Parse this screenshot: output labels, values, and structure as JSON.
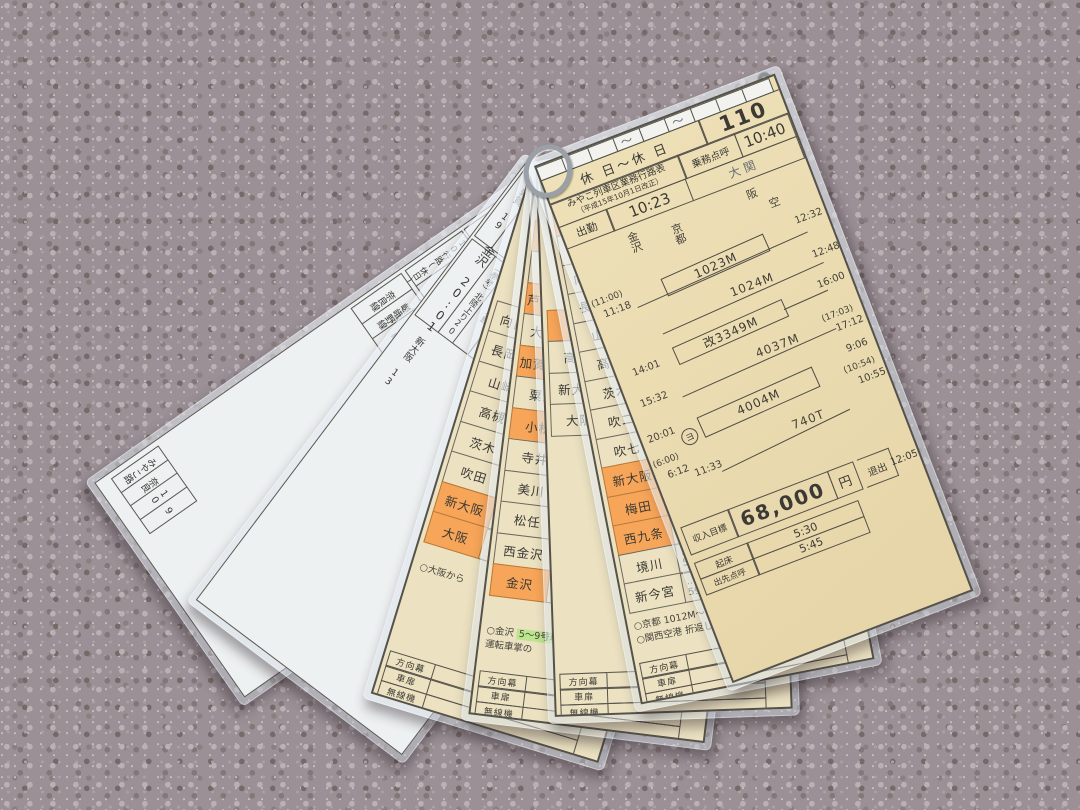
{
  "palette": {
    "carpet": "#9a9095",
    "paper_cream": "#ece2c2",
    "paper_tan": "#ead9b0",
    "paper_white": "#eef1f2",
    "highlight_orange": "#f7a558",
    "highlight_green": "#bde48e",
    "ink": "#3b3a35"
  },
  "card_top": {
    "header_day": "休 日～休 日",
    "route_no": "110",
    "title": "みやこ列車区業務行路表",
    "revision": "（平成15年10月1日改正）",
    "labels": {
      "shukkin": "出勤",
      "tenko": "乗務点呼",
      "taishutsu": "退出",
      "kisho": "起床",
      "shussaki": "出先点呼"
    },
    "times": {
      "shukkin": "10:23",
      "tenko": "10:40",
      "taishutsu": "12:05",
      "kisho": "5:30",
      "shussaki": "5:45"
    },
    "name_stamp": "大関",
    "diagram": {
      "axis": {
        "a1": "金沢",
        "a2": "京都",
        "a3": "阪",
        "a4": "空"
      },
      "s1": {
        "train": "1023M",
        "left1": "(11:00)",
        "left2": "11:18",
        "right1": "12:32"
      },
      "s2": {
        "train": "1024M",
        "right1": "12:48"
      },
      "s3": {
        "train": "改3349M",
        "left1": "14:01",
        "right1": "16:00"
      },
      "s4": {
        "train": "4037M",
        "left1": "15:32",
        "right1": "(17:03)",
        "right2": "17:12"
      },
      "s5": {
        "train": "4004M",
        "mark": "ヨ",
        "left1": "20:01",
        "left2": "(6:00)",
        "left3": "6:12",
        "right1": "9:06",
        "right2": "(10:54)",
        "right3": "10:55"
      },
      "s6": {
        "train": "740T",
        "left1": "11:33"
      }
    },
    "income": {
      "label": "収入目標",
      "amount": "68,000",
      "unit": "円"
    }
  },
  "card_kyoto": {
    "rows": [
      {
        "name": "京都",
        "hl": true,
        "t1": "",
        "t2": ""
      },
      {
        "name": "梅小路",
        "t1": "",
        "t2": ""
      },
      {
        "name": "向日町",
        "t1": "",
        "t2": ""
      },
      {
        "name": "長岡京",
        "t1": "",
        "t2": ""
      },
      {
        "name": "山崎",
        "t1": "",
        "t2": ""
      },
      {
        "name": "高槻",
        "t1": "",
        "t2": ""
      },
      {
        "name": "茨木",
        "t1": "",
        "t2": ""
      },
      {
        "name": "吹二",
        "t1": "",
        "t2": ""
      },
      {
        "name": "吹七",
        "t1": "",
        "t2": "45"
      },
      {
        "name": "新大阪",
        "hl": true,
        "t1": "11 45",
        "t2": "11 46"
      },
      {
        "name": "梅田",
        "hl": true,
        "t1": "…",
        "t2": "49 25"
      },
      {
        "name": "西九条",
        "hl": true,
        "t1": "11 53 20",
        "t2": "11 53 50"
      },
      {
        "name": "境川",
        "t1": "…",
        "t2": "56 30"
      },
      {
        "name": "新今宮",
        "t1": "…",
        "t2": "59 40"
      }
    ],
    "note1": "○京都 1012M～ 英放送あり",
    "note2": "○関西空港 折返し1024M"
  },
  "card_mid": {
    "rows": [
      {
        "name": "",
        "hl": true,
        "t1": "",
        "t2": ""
      },
      {
        "name": "高槻",
        "t1": "",
        "t2": ""
      },
      {
        "name": "新大阪",
        "t1": "",
        "t2": ""
      },
      {
        "name": "大阪",
        "t1": "",
        "t2": ""
      }
    ]
  },
  "card_hokuriku": {
    "rows": [
      {
        "name": "福井",
        "hl": true,
        "t1": "",
        "t2": ""
      },
      {
        "name": "丸岡",
        "t1": "",
        "t2": ""
      },
      {
        "name": "芦原温泉",
        "hl": true,
        "t1": "",
        "t2": ""
      },
      {
        "name": "大聖寺",
        "t1": "",
        "t2": ""
      },
      {
        "name": "加賀温泉",
        "hl": true,
        "t1": "",
        "t2": ""
      },
      {
        "name": "粟津",
        "t1": "",
        "t2": ""
      },
      {
        "name": "小松",
        "hl": true,
        "t1": "",
        "t2": ""
      },
      {
        "name": "寺井",
        "t1": "",
        "t2": ""
      },
      {
        "name": "美川",
        "t1": "",
        "t2": ""
      },
      {
        "name": "松任",
        "t1": "",
        "t2": ""
      },
      {
        "name": "西金沢",
        "t1": "",
        "t2": ""
      },
      {
        "name": "金沢",
        "hl": true,
        "t1": "20",
        "t2": ""
      }
    ],
    "note_head": "○金沢",
    "note_hl": "5～9号車",
    "note_tail": "運転車掌の"
  },
  "card_osaka": {
    "rows": [
      {
        "name": "向日町",
        "t1": "",
        "t2": ""
      },
      {
        "name": "長岡京",
        "t1": "",
        "t2": ""
      },
      {
        "name": "山崎",
        "t1": "",
        "t2": ""
      },
      {
        "name": "高槻",
        "t1": "",
        "t2": ""
      },
      {
        "name": "茨木",
        "t1": "",
        "t2": ""
      },
      {
        "name": "吹田",
        "t1": "",
        "t2": ""
      },
      {
        "name": "新大阪",
        "hl": true,
        "t1": "",
        "t2": ""
      },
      {
        "name": "大阪",
        "hl": true,
        "t1": "",
        "t2": ""
      }
    ],
    "note": "○大阪から"
  },
  "card_kanazawa": {
    "tips": [
      "敦賀 19",
      "武生 19",
      "鯖江 19",
      "福井 19 21",
      "芦原温泉 19 27",
      "加賀温泉 19 33",
      "小松 19 42"
    ],
    "kanazawa": "金沢  20:01",
    "ref": "（参考）北陸上り20",
    "lines": [
      "七尾線",
      "北陸線"
    ],
    "tab": "西九条",
    "mid": "新大阪 13"
  },
  "card_white": {
    "header_title": "110行路(休日)",
    "header_num": "740",
    "cells": [
      "新大阪 10:59",
      "関西空港 11:15",
      "高槻 11:12",
      "JR京都線 11:44",
      "京都 11:32",
      "嵯峨野線 11:38",
      "湖西線 11:45",
      "奈良線 11:50",
      "みやこ路快速",
      "普通"
    ],
    "second_name": "京都",
    "second_time": "14:00",
    "second_lines": [
      "奈良線",
      "嵯峨野線",
      "湖西線"
    ],
    "tabs": [
      "みやこ路",
      "奈良",
      "10",
      "9"
    ]
  },
  "footer_rows": {
    "r1": "方向幕",
    "r2": "車扉",
    "r3": "無線機"
  }
}
